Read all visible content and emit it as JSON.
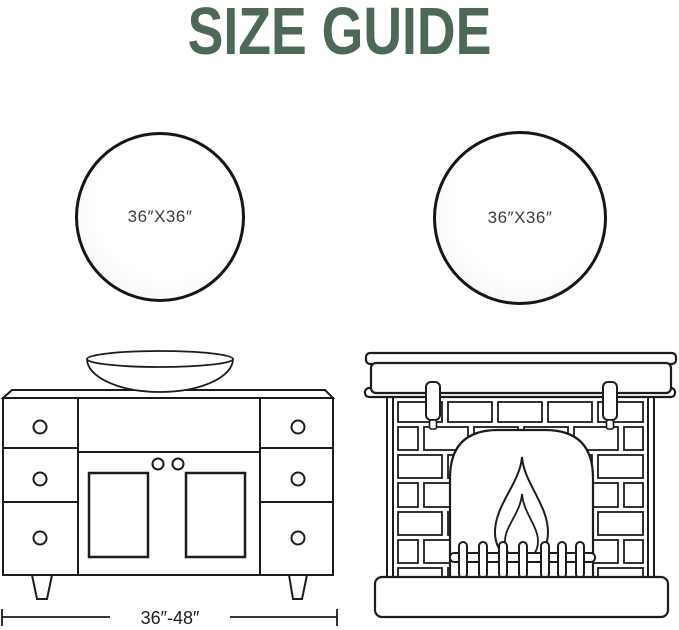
{
  "title": {
    "text": "SIZE GUIDE",
    "color": "#4d6854"
  },
  "mirrors": {
    "left": {
      "shape": "round",
      "label": "36″X36″"
    },
    "right": {
      "shape": "round",
      "label": "36″X36″"
    }
  },
  "vanity": {
    "illustration": "bathroom-vanity-line-drawing",
    "width_label": "36″-48″"
  },
  "fireplace": {
    "illustration": "fireplace-line-drawing"
  },
  "colors": {
    "line_art": "#1c1c1c",
    "mirror_border": "#161616",
    "mirror_label": "#3c3c3c",
    "background": "#ffffff"
  }
}
